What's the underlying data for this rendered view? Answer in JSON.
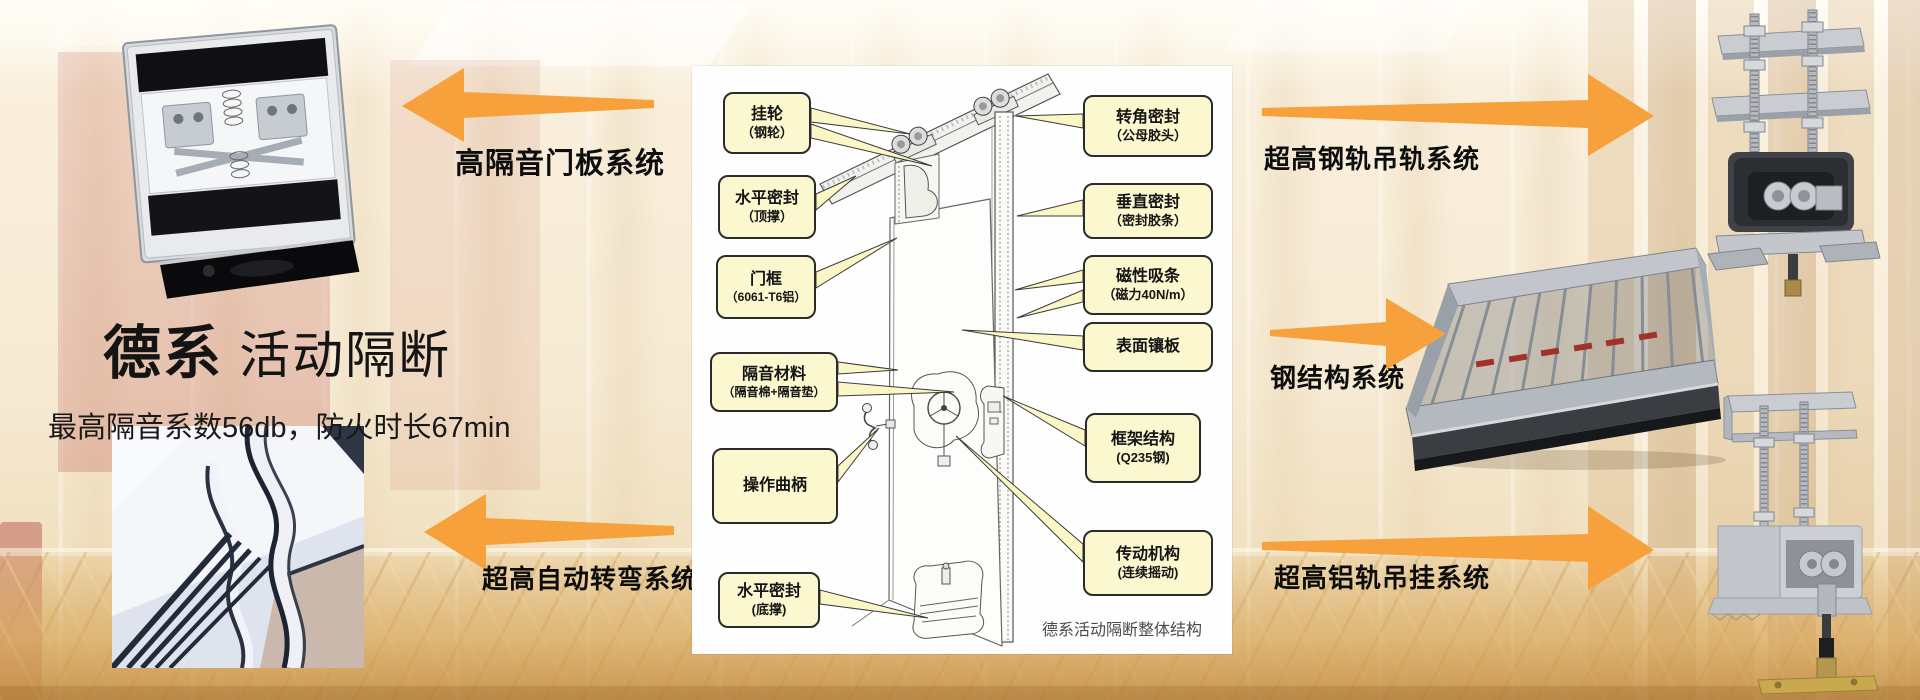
{
  "title": {
    "brand": "德系",
    "name": " 活动隔断",
    "subtitle": "最高隔音系数56db，防火时长67min"
  },
  "arrow_labels": {
    "left_top": "高隔音门板系统",
    "left_bottom": "超高自动转弯系统",
    "right_top": "超高钢轨吊轨系统",
    "right_middle": "钢结构系统",
    "right_bottom": "超高铝轨吊挂系统"
  },
  "diagram": {
    "caption": "德系活动隔断整体结构",
    "left_callouts": [
      {
        "title": "挂轮",
        "sub": "（钢轮）"
      },
      {
        "title": "水平密封",
        "sub": "（顶撑）"
      },
      {
        "title": "门框",
        "sub": "（6061-T6铝）"
      },
      {
        "title": "隔音材料",
        "sub": "（隔音棉+隔音垫）"
      },
      {
        "title": "操作曲柄",
        "sub": ""
      },
      {
        "title": "水平密封",
        "sub": "(底撑)"
      }
    ],
    "right_callouts": [
      {
        "title": "转角密封",
        "sub": "（公母胶头）"
      },
      {
        "title": "垂直密封",
        "sub": "（密封胶条）"
      },
      {
        "title": "磁性吸条",
        "sub": "（磁力40N/m）"
      },
      {
        "title": "表面镶板",
        "sub": ""
      },
      {
        "title": "框架结构",
        "sub": "(Q235钢)"
      },
      {
        "title": "传动机构",
        "sub": "(连续摇动)"
      }
    ]
  },
  "colors": {
    "accent_orange": "#F6A13B",
    "callout_bg": "#FBF7CF",
    "callout_border": "#2B2B2B"
  }
}
